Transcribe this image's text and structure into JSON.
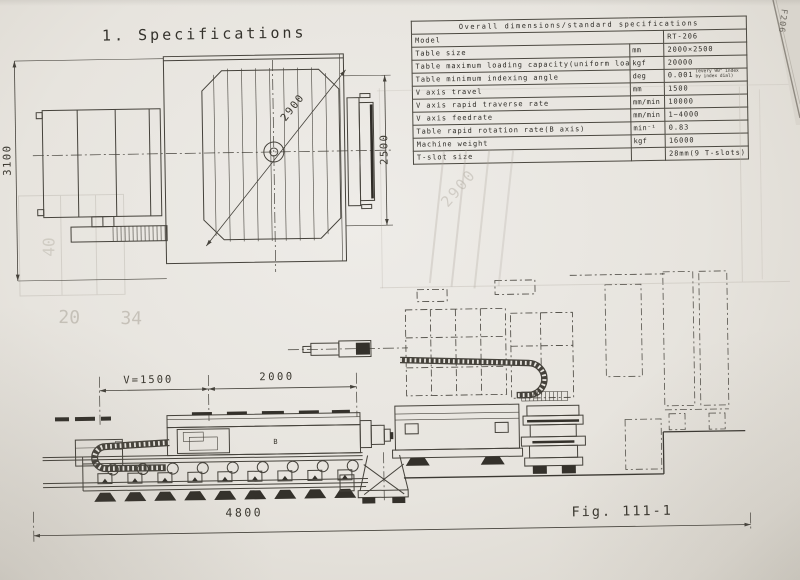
{
  "page": {
    "title": "1. Specifications",
    "figure_label": "Fig. 111-1",
    "edge_marking": "F206"
  },
  "spec_table": {
    "header": "Overall dimensions/standard specifications",
    "rows": [
      {
        "item": "Model",
        "unit": "",
        "value": "RT-206"
      },
      {
        "item": "Table size",
        "unit": "mm",
        "value": "2000×2500"
      },
      {
        "item": "Table maximum loading capacity(uniform load)",
        "unit": "kgf",
        "value": "20000"
      },
      {
        "item": "Table minimum indexing angle",
        "unit": "deg",
        "value": "0.001",
        "value_note": "(every 90° index by index dial)"
      },
      {
        "item": "V axis travel",
        "unit": "mm",
        "value": "1500"
      },
      {
        "item": "V axis rapid traverse rate",
        "unit": "mm/min",
        "value": "10000"
      },
      {
        "item": "V axis feedrate",
        "unit": "mm/min",
        "value": "1~4000"
      },
      {
        "item": "Table rapid rotation rate(B axis)",
        "unit": "min⁻¹",
        "value": "0.83"
      },
      {
        "item": "Machine weight",
        "unit": "kgf",
        "value": "16000"
      },
      {
        "item": "T-slot size",
        "unit": "",
        "value": "28mm(9 T-slots)"
      }
    ]
  },
  "plan_view": {
    "dim_overall_width": "3100",
    "dim_table_width": "2500",
    "dim_swing_diameter": "2900"
  },
  "elevation_view": {
    "dim_v_travel": "V=1500",
    "dim_span": "2000",
    "dim_overall_length": "4800",
    "axis_label": "B"
  },
  "ghost_marks": {
    "g1": "20",
    "g2": "34",
    "g3": "40",
    "g4": "2900"
  }
}
